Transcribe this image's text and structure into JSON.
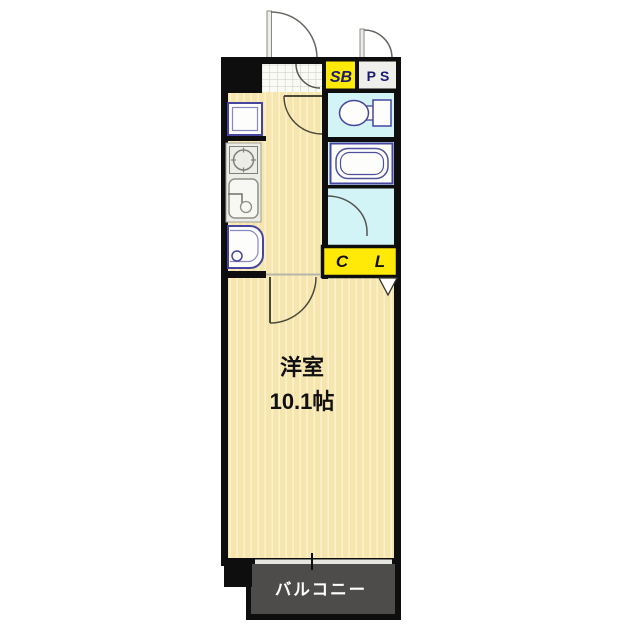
{
  "floor_plan": {
    "labels": {
      "shoe_box": "SB",
      "pipe_space": "PS",
      "closet_c": "C",
      "closet_l": "L",
      "main_room_name": "洋室",
      "main_room_size": "10.1帖",
      "balcony": "バルコニー"
    },
    "colors": {
      "wall": "#0E0E0E",
      "room_floor": "#F6E5AC",
      "room_floor_stripe": "#FBF1CE",
      "wet_area": "#D3F4F6",
      "label_yellow": "#FFE906",
      "pipe_space_gray": "#EFEFEB",
      "balcony_gray": "#4E4B4B",
      "balcony_text": "#FFFFFF",
      "fixture_outline": "#4646A0",
      "label_text_navy": "#1B1B70",
      "room_text": "#111111"
    },
    "icons": {
      "fixtures": [
        "entrance-door-swing-icon",
        "service-door-swing-icon",
        "genkan-door-swing-icon",
        "hall-door-swing-icon",
        "room-door-swing-icon",
        "washroom-door-swing-icon",
        "toilet-icon",
        "bathtub-icon",
        "refrigerator-icon",
        "stove-icon",
        "kitchen-sink-icon",
        "washbasin-icon",
        "closet-door-triangle-icon",
        "sliding-window-icon"
      ]
    }
  }
}
